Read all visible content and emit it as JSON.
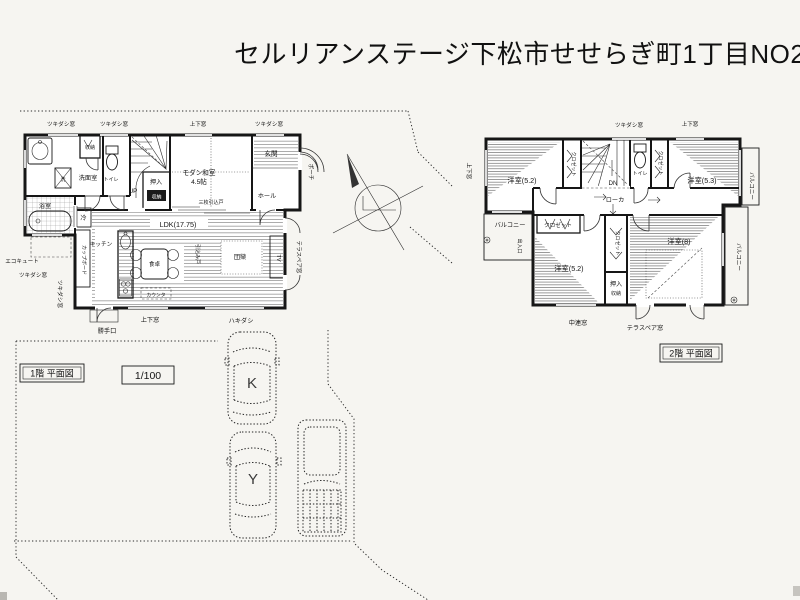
{
  "title": "セルリアンステージ下松市せせらぎ町1丁目NO2",
  "captions": {
    "floor1": "1階 平面図",
    "floor2": "2階 平面図",
    "scale": "1/100"
  },
  "windows": {
    "tsukidashi": "ツキダシ窓",
    "joge": "上下窓",
    "hakidashi": "ハキダシ",
    "terrace_pair": "テラスペア窓",
    "churen": "中連窓"
  },
  "floor1": {
    "senmen": "洗面室",
    "bath": "浴室",
    "wash": "洗",
    "toilet": "トイレ",
    "shuno": "収納",
    "up": "UP",
    "oshiire": "押入",
    "washitsu": "モダン和室",
    "washitsu_size": "4.5帖",
    "sanmai_door": "三枚引込戸",
    "hall": "ホール",
    "genkan": "玄関",
    "porch": "ポーチ",
    "ldk": "LDK(17.75)",
    "kitchen": "キッチン",
    "fridge": "冷",
    "cupboard": "カップボード",
    "dining_table": "食卓",
    "hikikomi_door": "引込み戸",
    "danran": "団欒",
    "tv": "TV",
    "counter": "カウンタ",
    "katteguchi": "勝手口",
    "ecocute": "エコキュート"
  },
  "floor2": {
    "bed52": "洋室(5.2)",
    "bed53": "洋室(5.3)",
    "bed8": "洋室(8)",
    "closet": "クロゼット",
    "toilet": "トイレ",
    "dn": "DN",
    "roka": "ローカ",
    "balcony": "バルコニー",
    "oshiire": "押入",
    "shuno": "収納",
    "deiriguchi": "出入口"
  },
  "site": {
    "car_k": "K",
    "car_y": "Y"
  },
  "colors": {
    "ink": "#161616",
    "paper": "#f6f5f1"
  }
}
